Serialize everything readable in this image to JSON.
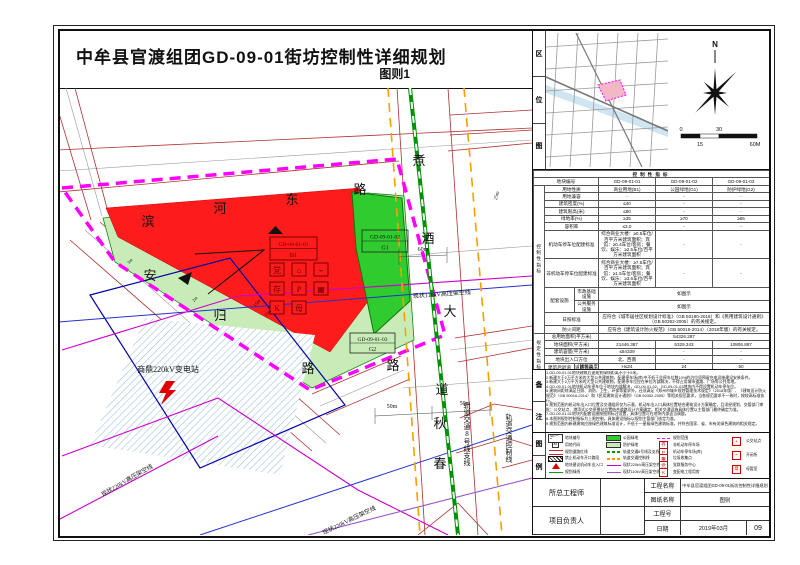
{
  "page": {
    "title": "中牟县官渡组团GD-09-01街坊控制性详细规划",
    "sheet_label": "图则1"
  },
  "location": {
    "label": "区位图",
    "north": "N",
    "scale": {
      "s0": "0",
      "s30": "30",
      "s15": "15",
      "s60": "60M"
    }
  },
  "table": {
    "title": "控制性指标",
    "group1": "控制性指标",
    "group2": "规定性指标",
    "rows": [
      {
        "label": "地块编号",
        "group": 0,
        "cells": [
          "GD-09-01-01",
          "GD-09-01-02",
          "GD-09-01-03"
        ]
      },
      {
        "label": "用地性质",
        "group": 1,
        "cells": [
          "商业用地(B1)",
          "公园绿地(G1)",
          "防护绿地(G2)"
        ]
      },
      {
        "label": "用地兼容",
        "group": 1,
        "cells": [
          "-",
          "-",
          "-"
        ]
      },
      {
        "label": "建筑密度(%)",
        "group": 1,
        "cells": [
          "≤40",
          "-",
          "-"
        ]
      },
      {
        "label": "建筑限高(米)",
        "group": 1,
        "cells": [
          "≤80",
          "-",
          "-"
        ]
      },
      {
        "label": "绿地率(%)",
        "group": 1,
        "cells": [
          "≥35",
          "≥70",
          "≥65"
        ]
      },
      {
        "label": "容积率",
        "group": 1,
        "cells": [
          "≤3.0",
          "-",
          "-"
        ]
      },
      {
        "label": "机动车停车位配建标准",
        "group": 1,
        "long": true,
        "cells": [
          "综合商业大楼：≥0.5车位/百平方米建筑面积；宾馆：≥0.4车位/客房；餐饮、娱乐：≥2.5车位/百平方米建筑面积",
          "-",
          "-"
        ]
      },
      {
        "label": "非机动车停车位配建标准",
        "group": 1,
        "long": true,
        "cells": [
          "综合商业大楼：≥7.5车位/百平方米建筑面积；宾馆：≥1.5车位/客房；餐饮、娱乐：≥3.6车位/百平方米建筑面积",
          "-",
          "-"
        ]
      },
      {
        "label": "配套设施",
        "group": 1,
        "sub": [
          [
            "市政基础设施",
            "如图示"
          ],
          [
            "公共服务设施",
            "如图示"
          ]
        ]
      },
      {
        "label": "日照标准",
        "group": 1,
        "span": "应符合《城市居住区规划设计标准》（GB 50180-2018）和《民用建筑设计通则》（GB 50352-2005）的有关规定。"
      },
      {
        "label": "防火间距",
        "group": 1,
        "span": "应符合《建筑设计防火规范》（GB 50016-2014）（2018年版）的有关规定。"
      },
      {
        "label": "总用地面积(平方米)",
        "group": 2,
        "span": "54326.287"
      },
      {
        "label": "地块面积(平方米)",
        "group": 2,
        "cells": [
          "21446.387",
          "5329.343",
          "10806.897"
        ]
      },
      {
        "label": "建筑容量(平方米)",
        "group": 2,
        "cells": [
          "≤64339",
          "-",
          "-"
        ]
      },
      {
        "label": "地块出入口方位",
        "group": 2,
        "cells": [
          "北、西南",
          "-",
          "-"
        ]
      },
      {
        "label": "建筑后退道路红线(米)",
        "group": 2,
        "setback": {
          "corner": "建筑高度",
          "corner2": "道路等级",
          "cols": [
            "H≤24",
            "24<H≤50",
            "50<H≤100"
          ],
          "rowlabel": "城市道路",
          "vals": [
            "10",
            "15",
            "20"
          ]
        }
      }
    ]
  },
  "notes": {
    "label": "备注",
    "lines": [
      "1.GD-09-01-01地块建筑后退规划绿线距离不小于5米。",
      "2.新建大于2万平方米的大型公共建筑物，配建停车场(库)中不低于总停车位数10%的泊位须预留充电设施建设安装条件。",
      "3.新建大于2万平方米的大型公共建筑物，配建停车位应在单位内部解决，不得占用城市道路、广场等公共用地。",
      "4.GD-09-01-01地块机动车停车位于地块内部解决，GD-09-01-02、GD-09-01-03地块内不得设置机动车停车位。",
      "5.建筑间距除满足日照、消防、卫生、环保等要求外，还须满足《郑州市城乡规划管理技术规定》（2018年版）、《建筑设计防火规范》（GB 50016-2014）和《民用建筑设计通则》（GB 50352-2005）等相关规范要求，当各规范要求不一致时，按较高标准执行。",
      "6.规划范围内机动车出入口位置及交通组织仅为示意，机动车出入口具体位置结合建筑设计方案确定，且须经规划、交管部门审批；公交站点、港湾式公交停靠站位置结合道路设计方案确定，相关交通设施具体位置以主管部门最终确定为准。",
      "7.GD-09-01-01地块内配套设施按图则标注设置，具体位置可在地块内部适当调整。",
      "8.本图则规划控制指标为上限控制，具体建设指标以规划主管部门核定为准。",
      "9.规划范围内新建建筑应按绿色建筑标准设计，不低于一星级绿色建筑标准，并符合国家、省、市有关绿色建筑的相关规定。"
    ]
  },
  "legend": {
    "label": "图例",
    "cols": [
      [
        {
          "t": "plotbox",
          "text": "GD-**-**",
          "label": "地块编号"
        },
        {
          "t": "plot_code_box",
          "text": "B1",
          "label": "用地代码"
        },
        {
          "t": "redline",
          "label": "规划道路红线"
        },
        {
          "t": "hatchbar",
          "label": "禁止机动车开口路段"
        },
        {
          "t": "tri",
          "label": "地块建议机动车出入口"
        },
        {
          "t": "line",
          "c": "#00a000",
          "label": "规划绿线"
        }
      ],
      [
        {
          "t": "fill",
          "c": "#2fcb2f",
          "label": "公园绿地"
        },
        {
          "t": "fill",
          "c": "#c8ecb8",
          "label": "防护绿地"
        },
        {
          "t": "dash",
          "c": "#00a000",
          "label": "轨道交通8号线及支线"
        },
        {
          "t": "dash",
          "c": "#ff9d00",
          "label": "轨道交通控制线"
        },
        {
          "t": "line",
          "c": "#cc00cc",
          "label": "现状220kV高压架空线"
        },
        {
          "t": "line",
          "c": "#9955cc",
          "label": "现状110kV高压架空线"
        }
      ],
      [
        {
          "t": "dash",
          "c": "#ff00ff",
          "label": "规划范围"
        },
        {
          "t": "icon",
          "g": "存",
          "label": "非机动车停车场"
        },
        {
          "t": "icon",
          "g": "P",
          "label": "机动车停车场(库)"
        },
        {
          "t": "icon",
          "g": "▦",
          "label": "垃圾收集点"
        },
        {
          "t": "icon",
          "g": "党",
          "label": "党群服务中心"
        },
        {
          "t": "icon",
          "g": "K",
          "label": "变配电工程用房"
        }
      ],
      [
        {
          "t": "icon",
          "g": "+",
          "label": "公交站点"
        },
        {
          "t": "icon",
          "g": "⌁",
          "label": "开闭所"
        },
        {
          "t": "icon",
          "g": "母",
          "label": "母婴室"
        }
      ]
    ]
  },
  "titleblock": {
    "chief_label": "所总工程师",
    "pm_label": "项目负责人",
    "project_label": "工程名称",
    "project": "中牟县官渡组团GD-09-01街坊控制性详细规划",
    "drawing_label": "图纸名称",
    "drawing": "图则",
    "no_label": "工程号",
    "no": "",
    "date_label": "日期",
    "date": "2019年03月",
    "sheet_no": "09"
  },
  "map": {
    "plot1": {
      "no": "GD-09-01-01",
      "code": "B1"
    },
    "plot2": {
      "no": "GD-09-01-02",
      "code": "G1"
    },
    "plot3": {
      "no": "GD-09-01-03",
      "code": "G2"
    },
    "substation": "商鼎220kV变电站",
    "icons": [
      "党",
      "⌂",
      "⌁",
      "存",
      "P",
      "▦",
      "K",
      "母"
    ],
    "street_chars": [
      {
        "c": "滨",
        "x": 90,
        "y": 138
      },
      {
        "c": "河",
        "x": 162,
        "y": 125
      },
      {
        "c": "东",
        "x": 234,
        "y": 116
      },
      {
        "c": "路",
        "x": 302,
        "y": 106
      },
      {
        "c": "煮",
        "x": 361,
        "y": 77
      },
      {
        "c": "酒",
        "x": 370,
        "y": 155
      },
      {
        "c": "大",
        "x": 392,
        "y": 228
      },
      {
        "c": "道",
        "x": 384,
        "y": 306
      },
      {
        "c": "安",
        "x": 92,
        "y": 192
      },
      {
        "c": "归",
        "x": 162,
        "y": 232
      },
      {
        "c": "路",
        "x": 250,
        "y": 285
      },
      {
        "c": "路",
        "x": 335,
        "y": 282
      },
      {
        "c": "秋",
        "x": 382,
        "y": 340
      },
      {
        "c": "春",
        "x": 382,
        "y": 380
      }
    ],
    "labels": [
      {
        "t": "商鼎220kV变电站",
        "x": 110,
        "y": 284,
        "s": 8
      },
      {
        "t": "现状110kV高压架空线",
        "x": 384,
        "y": 208,
        "s": 6,
        "r": -4
      },
      {
        "t": "现状220kV高压架空线",
        "x": 70,
        "y": 394,
        "s": 6,
        "r": -30
      },
      {
        "t": "现状220kV高压架空线",
        "x": 292,
        "y": 434,
        "s": 6,
        "r": -26
      },
      {
        "t": "轨道交通8号线支线",
        "x": 409,
        "y": 346,
        "s": 7,
        "vert": true
      },
      {
        "t": "轨道交通控制线",
        "x": 451,
        "y": 350,
        "s": 7,
        "vert": true
      },
      {
        "t": "60m",
        "x": 365,
        "y": 163,
        "s": 6
      },
      {
        "t": "50m",
        "x": 334,
        "y": 320,
        "s": 6
      },
      {
        "t": "50m",
        "x": 407,
        "y": 317,
        "s": 6
      },
      {
        "t": "25m",
        "x": 440,
        "y": 108,
        "s": 5,
        "r": -75
      },
      {
        "t": "3m",
        "x": 73,
        "y": 174,
        "s": 4.5,
        "r": -50
      },
      {
        "t": "2m",
        "x": 138,
        "y": 212,
        "s": 4.5,
        "r": -50
      },
      {
        "t": "15m",
        "x": 200,
        "y": 216,
        "s": 4.5,
        "r": -50
      },
      {
        "t": "15m",
        "x": 211,
        "y": 226,
        "s": 4.5,
        "r": -50
      }
    ]
  }
}
